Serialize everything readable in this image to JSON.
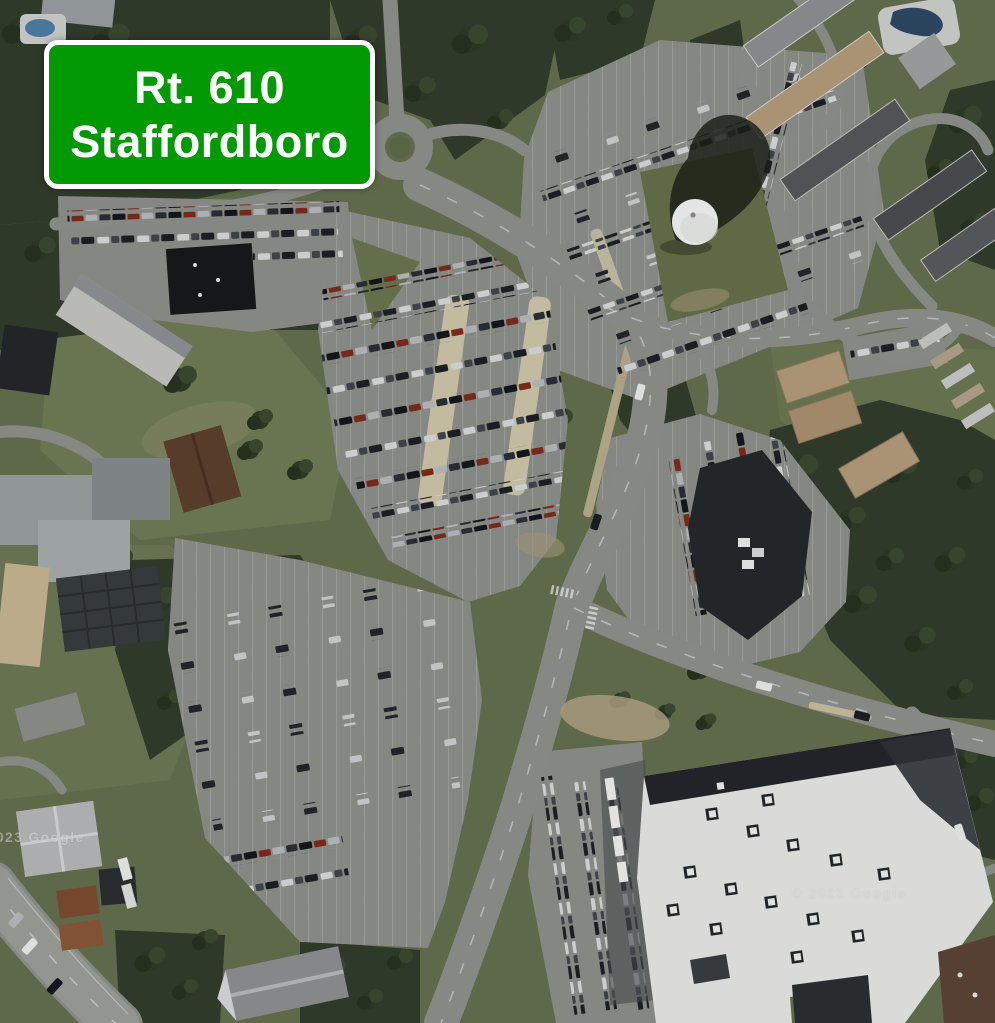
{
  "sign": {
    "line1": "Rt. 610",
    "line2": "Staffordboro",
    "background_color": "#029a02",
    "border_color": "#ffffff",
    "text_color": "#ffffff"
  },
  "watermarks": {
    "left": "© 2023 Google",
    "right": "© 2023 Google"
  },
  "scene": {
    "type": "satellite-aerial-imagery",
    "features": [
      "roundabout",
      "commuter parking lots with parked cars",
      "water tower with shadow",
      "office building",
      "big-box store with white roof",
      "townhouses and swimming pool",
      "school complex",
      "forest and lawns",
      "multi-lane highway"
    ],
    "colors": {
      "forest": "#333d2c",
      "grass": "#65714f",
      "road": "#8f928d",
      "parking": "#8e918c",
      "store_roof": "#e9eae7",
      "water_tower": "#f4f5f4",
      "pool": "#2e4a66"
    }
  }
}
